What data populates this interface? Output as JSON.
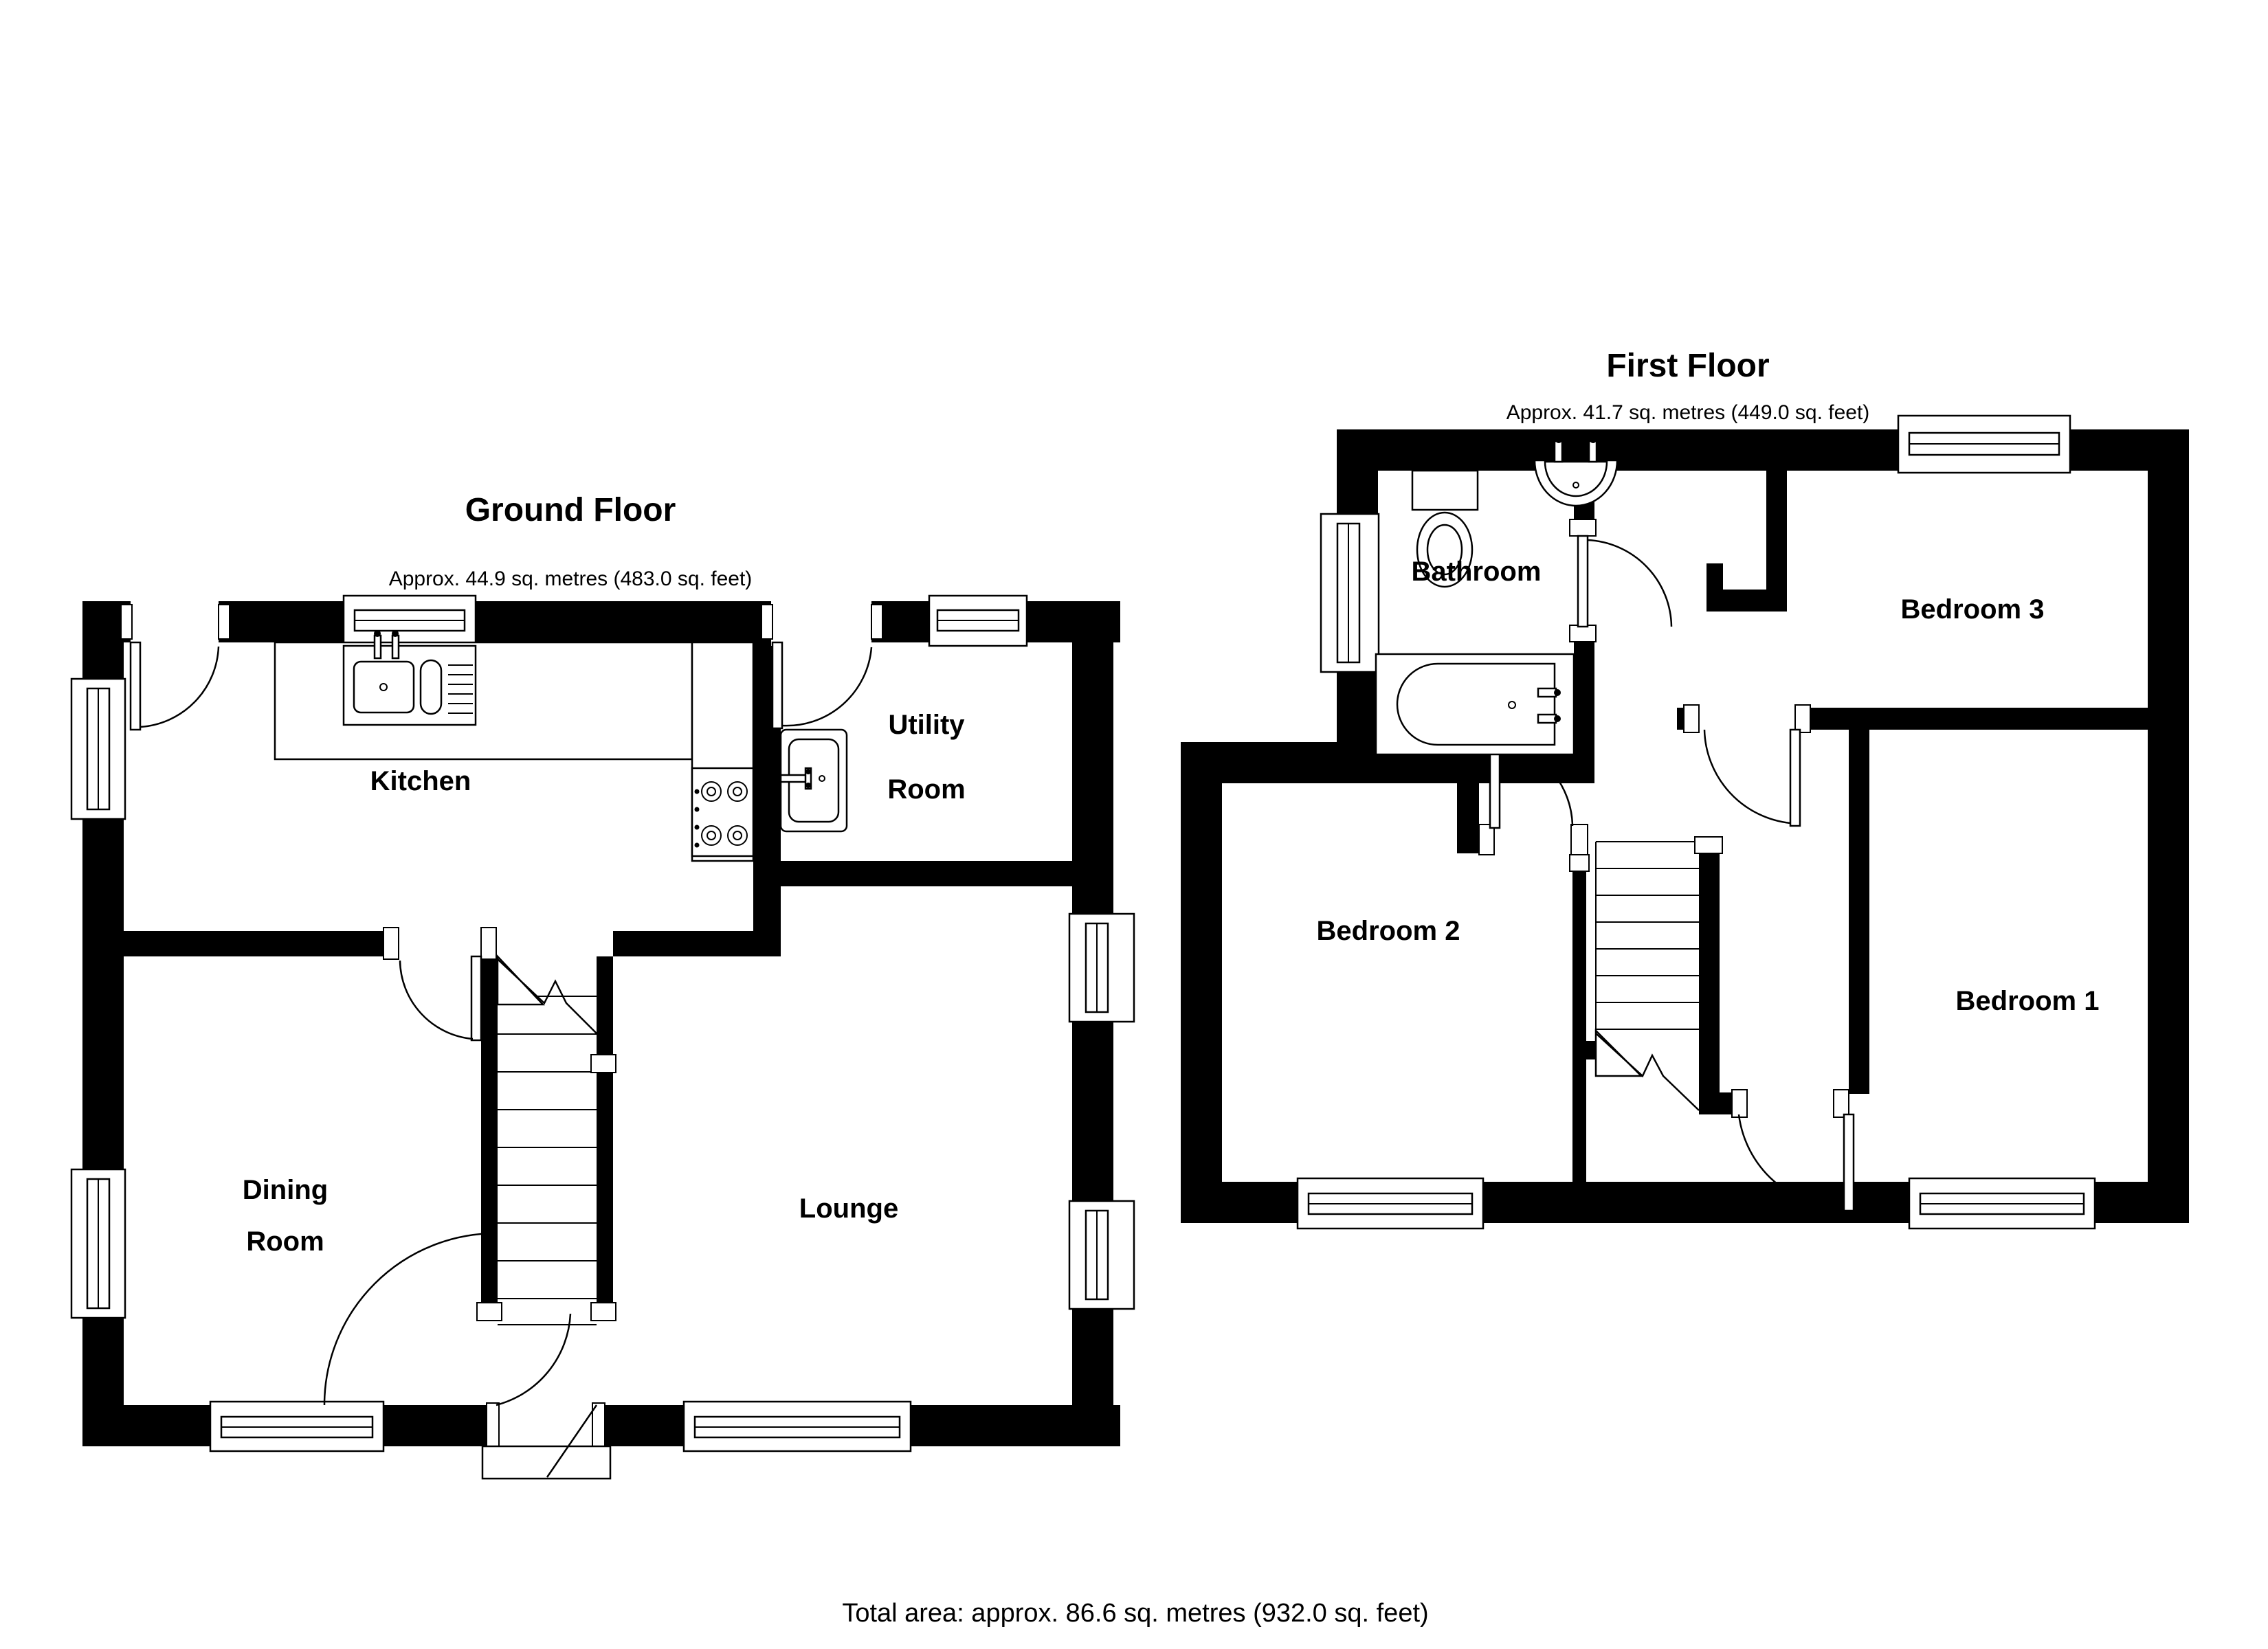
{
  "page": {
    "background_color": "#ffffff",
    "wall_color": "#000000",
    "total_area_label": "Total area: approx. 86.6 sq. metres (932.0 sq. feet)"
  },
  "ground_floor": {
    "title": "Ground Floor",
    "area": "Approx. 44.9 sq. metres (483.0 sq. feet)",
    "rooms": {
      "kitchen": {
        "label": "Kitchen"
      },
      "utility_room": {
        "label": "Utility Room",
        "lines": [
          "Utility",
          "Room"
        ]
      },
      "dining_room": {
        "label": "Dining Room",
        "lines": [
          "Dining",
          "Room"
        ]
      },
      "lounge": {
        "label": "Lounge"
      }
    },
    "fixtures": {
      "kitchen_sink": "double-sink-with-drainer-icon",
      "hob": "four-ring-hob-icon",
      "utility_sink": "utility-sink-icon",
      "staircase": "staircase-up-icon",
      "front_door": "front-entrance-door-icon",
      "porch": "porch-step-icon"
    }
  },
  "first_floor": {
    "title": "First Floor",
    "area": "Approx. 41.7 sq. metres (449.0 sq. feet)",
    "rooms": {
      "bathroom": {
        "label": "Bathroom"
      },
      "bedroom3": {
        "label": "Bedroom 3"
      },
      "bedroom2": {
        "label": "Bedroom 2"
      },
      "bedroom1": {
        "label": "Bedroom 1"
      }
    },
    "fixtures": {
      "toilet": "toilet-icon",
      "basin": "wash-basin-icon",
      "bath": "bathtub-icon",
      "staircase": "staircase-down-icon"
    }
  }
}
